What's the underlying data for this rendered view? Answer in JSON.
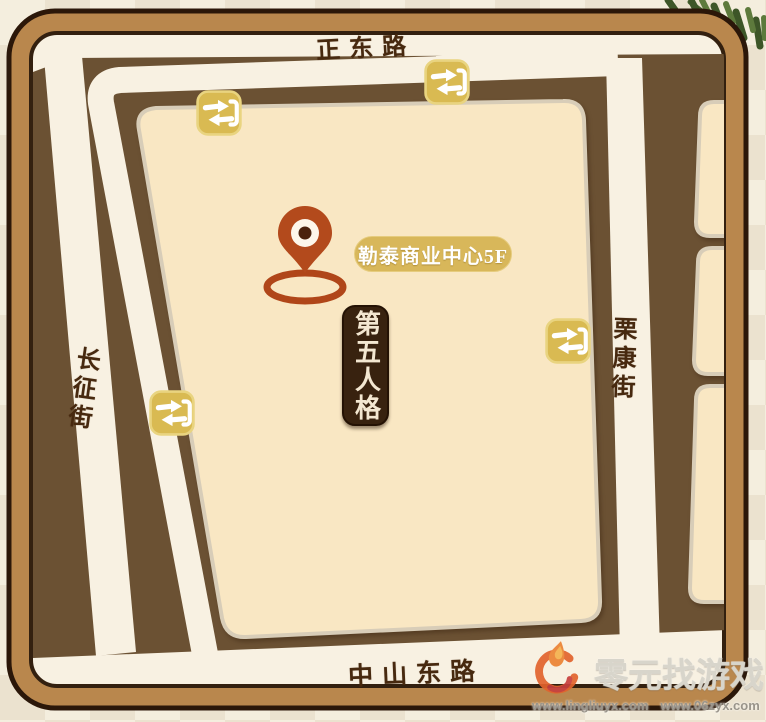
{
  "map": {
    "roads": {
      "north": {
        "label": "正东路"
      },
      "south": {
        "label": "中山东路"
      },
      "west": {
        "label": "长征街"
      },
      "east": {
        "label": "栗康街"
      }
    },
    "destination_pill": {
      "label": "勒泰商业中心5F",
      "bg_color": "#d8b75a",
      "text_color": "#ffffff"
    },
    "venue_banner": {
      "label": "第五人格",
      "bg_color": "#38220f",
      "text_color": "#f3e7d1"
    },
    "transfer_icons": {
      "glyph": "transfer-arrows-bracket",
      "count": 4,
      "color": "#d9ba52"
    },
    "pin": {
      "color": "#b34a1c"
    },
    "palette": {
      "frame": "#b9874d",
      "outline": "#2b1709",
      "blocks_dark": "#6b5133",
      "blocks_light": "#f9e7c3",
      "road": "#f8f1e2",
      "page_bg": "#f4eede"
    }
  },
  "watermark": {
    "brand": "零元找游戏",
    "urls": [
      "www.lingliuyx.com",
      "www.06zyx.com"
    ]
  }
}
